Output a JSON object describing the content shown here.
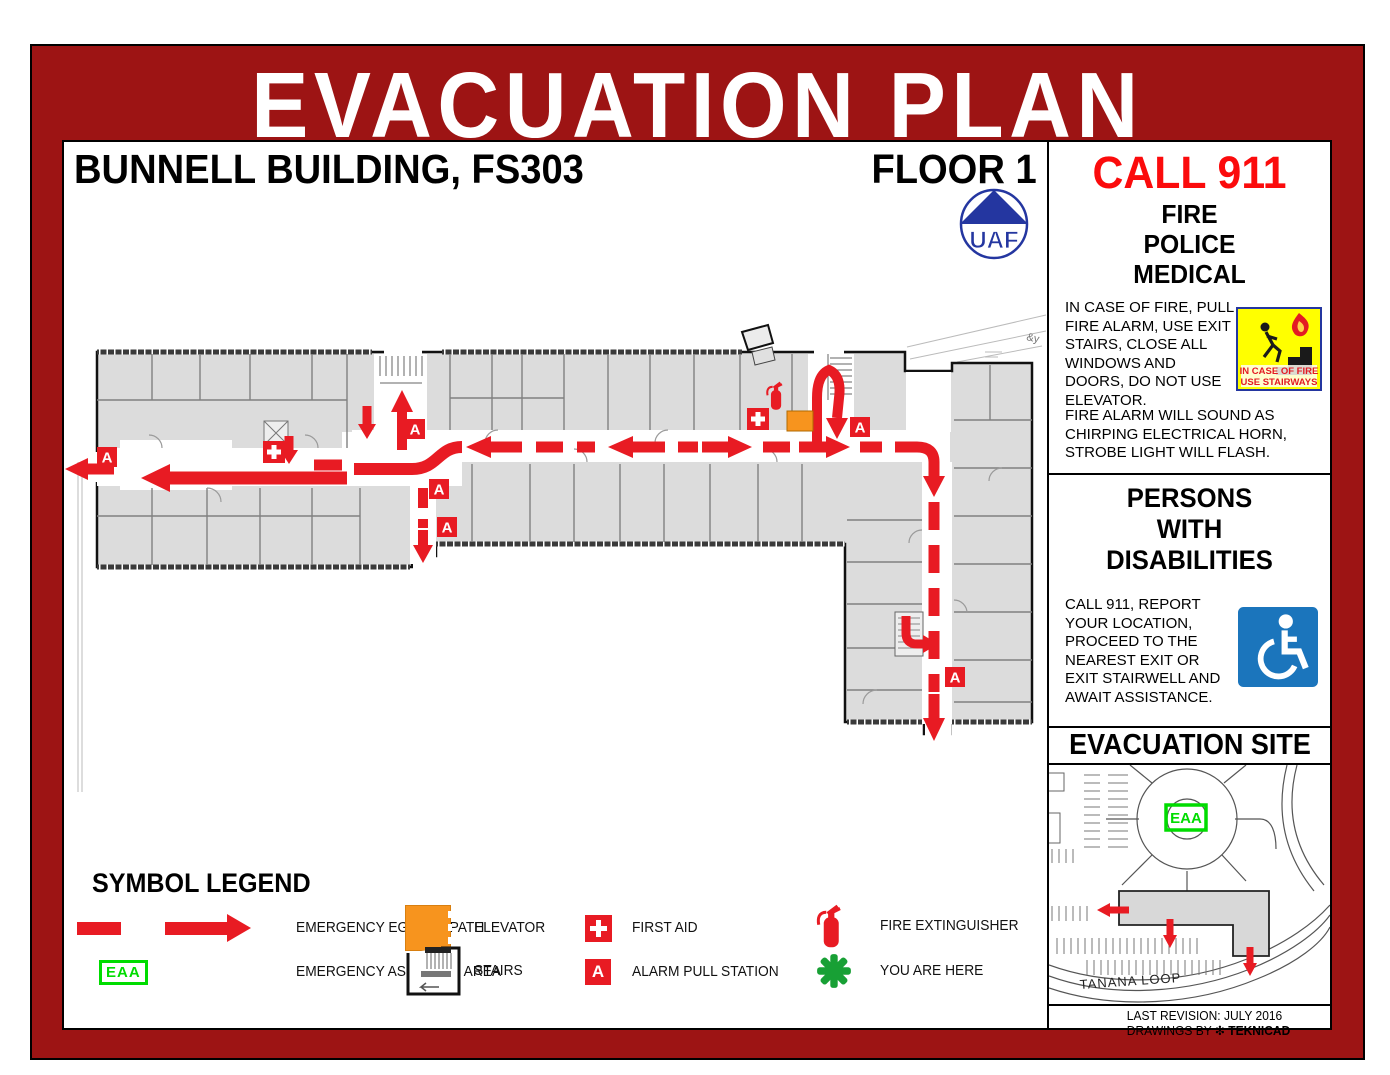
{
  "title": "EVACUATION PLAN",
  "header": {
    "building": "BUNNELL BUILDING, FS303",
    "floor": "FLOOR 1",
    "logo_text": "UAF"
  },
  "emergency": {
    "call": "CALL 911",
    "services": [
      "FIRE",
      "POLICE",
      "MEDICAL"
    ],
    "fire_instructions": "IN CASE OF FIRE, PULL FIRE ALARM, USE EXIT STAIRS, CLOSE ALL WINDOWS AND DOORS, DO NOT USE ELEVATOR.",
    "alarm_note": "FIRE ALARM WILL SOUND AS CHIRPING ELECTRICAL HORN, STROBE LIGHT WILL FLASH.",
    "stair_sign": {
      "line1": "IN CASE OF FIRE",
      "line2": "USE STAIRWAYS"
    }
  },
  "disabilities": {
    "title_lines": [
      "PERSONS",
      "WITH",
      "DISABILITIES"
    ],
    "instructions": "CALL 911, REPORT YOUR LOCATION, PROCEED TO THE NEAREST EXIT OR EXIT STAIRWELL AND AWAIT ASSISTANCE."
  },
  "site": {
    "title": "EVACUATION SITE",
    "assembly_label": "EAA",
    "street": "TANANA LOOP"
  },
  "legend": {
    "title": "SYMBOL LEGEND",
    "items": [
      {
        "icon": "egress-path-arrow",
        "label": "EMERGENCY EGRESS PATH"
      },
      {
        "icon": "elevator-swatch",
        "label": "ELEVATOR"
      },
      {
        "icon": "first-aid-cross",
        "label": "FIRST AID"
      },
      {
        "icon": "fire-extinguisher",
        "label": "FIRE EXTINGUISHER"
      },
      {
        "icon": "assembly-area-box",
        "label": "EMERGENCY ASSEMBLY AREA",
        "box_text": "EAA"
      },
      {
        "icon": "stairs",
        "label": "STAIRS"
      },
      {
        "icon": "alarm-pull-station",
        "label": "ALARM PULL STATION",
        "box_text": "A"
      },
      {
        "icon": "you-are-here-star",
        "label": "YOU ARE HERE"
      }
    ]
  },
  "plan": {
    "alarm_letter": "A"
  },
  "footer": {
    "revision": "LAST REVISION: JULY 2016",
    "credit_prefix": "DRAWINGS BY",
    "credit_name": "TEKNICAD"
  },
  "colors": {
    "frame_red": "#9D1414",
    "call911_red": "#FB0B0C",
    "egress_red": "#E81B23",
    "elevator_orange": "#F7941E",
    "assembly_green": "#00DC00",
    "you_are_here_green": "#18A035",
    "ada_blue": "#1B75BC",
    "sign_yellow": "#FFFF00",
    "room_gray": "#DCDCDC"
  }
}
